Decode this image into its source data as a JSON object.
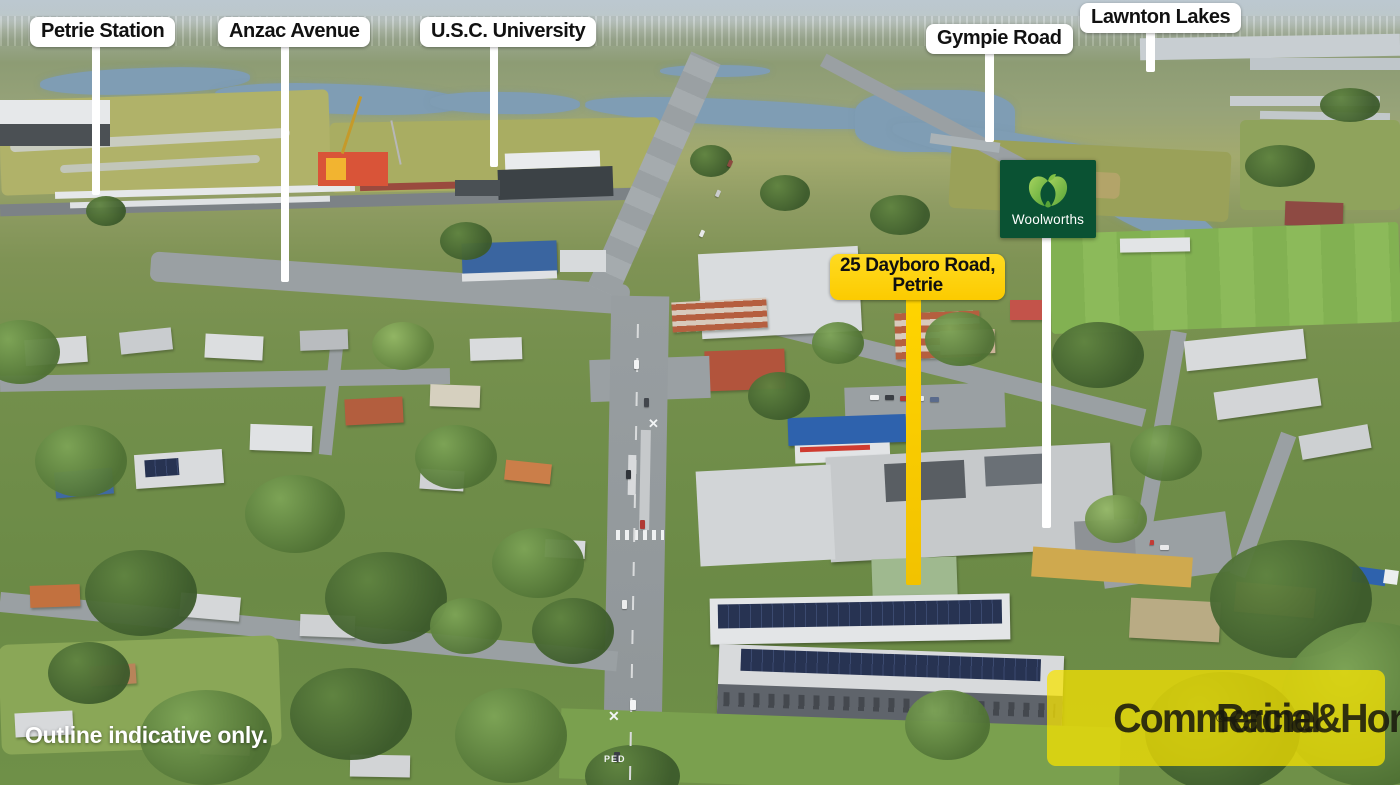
{
  "labels": [
    {
      "text": "Petrie Station"
    },
    {
      "text": "Anzac Avenue"
    },
    {
      "text": "U.S.C. University"
    },
    {
      "text": "Gympie Road"
    },
    {
      "text": "Lawnton Lakes"
    }
  ],
  "property_label": {
    "line1": "25 Dayboro Road,",
    "line2": "Petrie"
  },
  "woolworths": {
    "wordmark": "Woolworths"
  },
  "disclaimer": "Outline indicative only.",
  "brand": {
    "name": "Raine&Horne",
    "registered": "®",
    "division": "Commercial"
  },
  "road_markings": {
    "cross": "✕",
    "ped": "PED"
  },
  "colors": {
    "label_bg": "#FFFFFF",
    "label_text": "#111111",
    "accent_yellow": "#FFD400",
    "brand_yellow": "#F7E300",
    "woolworths_green": "#0A5233",
    "woolworths_apple": "#7FC143",
    "water": "#7F9DB4",
    "field": "#A9AD62",
    "grass": "#6F9048",
    "road": "#9AA0A3"
  }
}
